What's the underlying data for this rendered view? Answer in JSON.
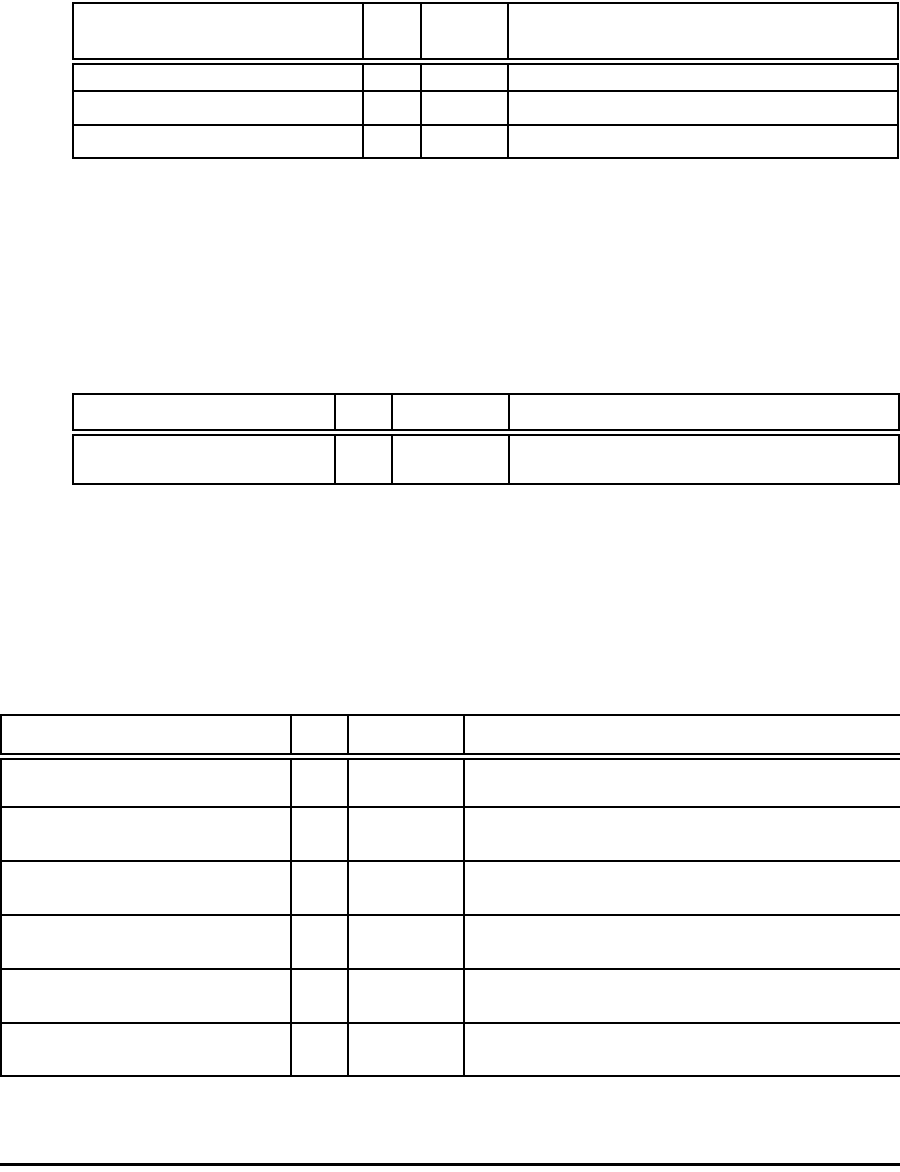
{
  "colors": {
    "border": "#000000",
    "background": "#ffffff"
  },
  "tables": [
    {
      "name": "top-table",
      "header": [
        "",
        "",
        "",
        ""
      ],
      "rows": [
        [
          "",
          "",
          "",
          ""
        ],
        [
          "",
          "",
          "",
          ""
        ],
        [
          "",
          "",
          "",
          ""
        ]
      ]
    },
    {
      "name": "middle-table",
      "header": [
        "",
        "",
        "",
        ""
      ],
      "rows": [
        [
          "",
          "",
          "",
          ""
        ]
      ]
    },
    {
      "name": "bottom-table",
      "header": [
        "",
        "",
        "",
        ""
      ],
      "rows": [
        [
          "",
          "",
          "",
          ""
        ],
        [
          "",
          "",
          "",
          ""
        ],
        [
          "",
          "",
          "",
          ""
        ],
        [
          "",
          "",
          "",
          ""
        ],
        [
          "",
          "",
          "",
          ""
        ],
        [
          "",
          "",
          "",
          ""
        ]
      ]
    }
  ]
}
